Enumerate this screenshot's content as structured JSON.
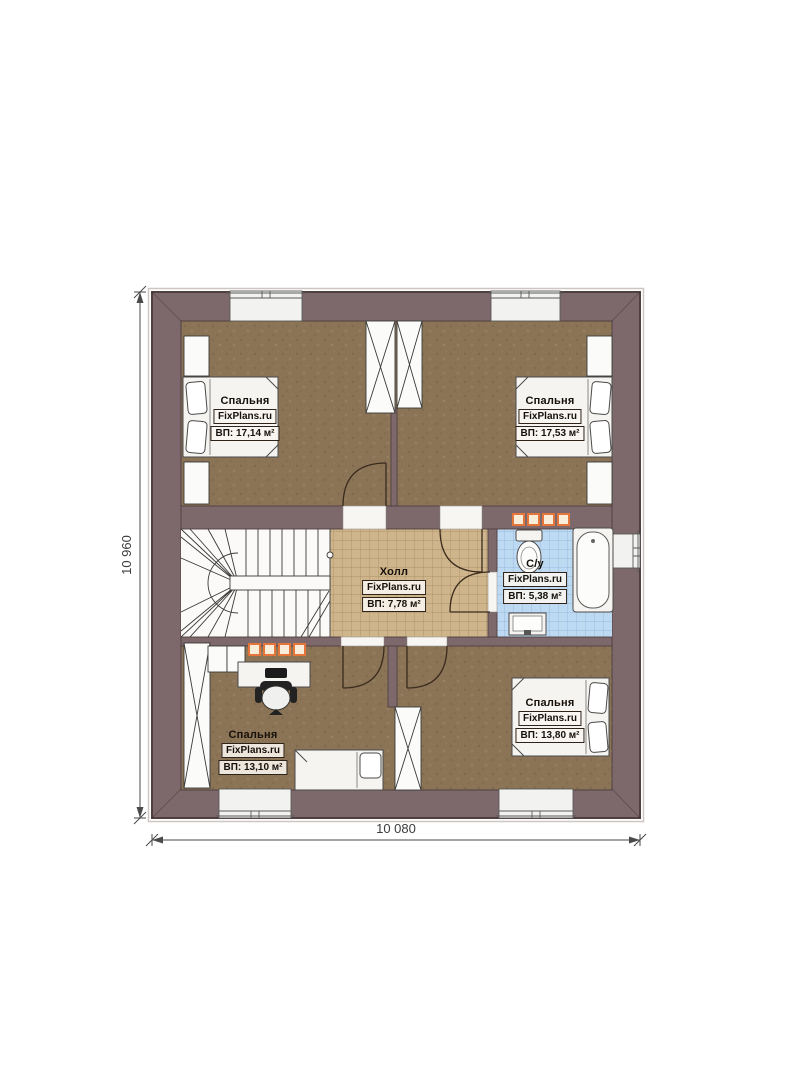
{
  "plan_title": "floor-plan-second-floor",
  "watermark": "FixPlans.ru",
  "rooms": [
    {
      "id": "bedroom-top-left",
      "name": "Спальня",
      "brand": "FixPlans.ru",
      "area": "ВП: 17,14 м²"
    },
    {
      "id": "bedroom-top-right",
      "name": "Спальня",
      "brand": "FixPlans.ru",
      "area": "ВП: 17,53 м²"
    },
    {
      "id": "hall",
      "name": "Холл",
      "brand": "FixPlans.ru",
      "area": "ВП: 7,78 м²"
    },
    {
      "id": "bathroom",
      "name": "С/у",
      "brand": "FixPlans.ru",
      "area": "ВП: 5,38 м²"
    },
    {
      "id": "bedroom-bottom-left",
      "name": "Спальня",
      "brand": "FixPlans.ru",
      "area": "ВП: 13,10 м²"
    },
    {
      "id": "bedroom-bottom-right",
      "name": "Спальня",
      "brand": "FixPlans.ru",
      "area": "ВП: 13,80 м²"
    }
  ],
  "dimensions": {
    "height_label": "10 960",
    "width_label": "10 080"
  },
  "colors": {
    "wall-color": "#7d696b",
    "wall-stroke": "#4f3f41",
    "bedroom-floor": "#8b7456",
    "hall-floor": "#cfb58c",
    "bath-floor": "#bedaf3",
    "accent-orange": "#e4763b",
    "label-border": "#2e2318"
  }
}
